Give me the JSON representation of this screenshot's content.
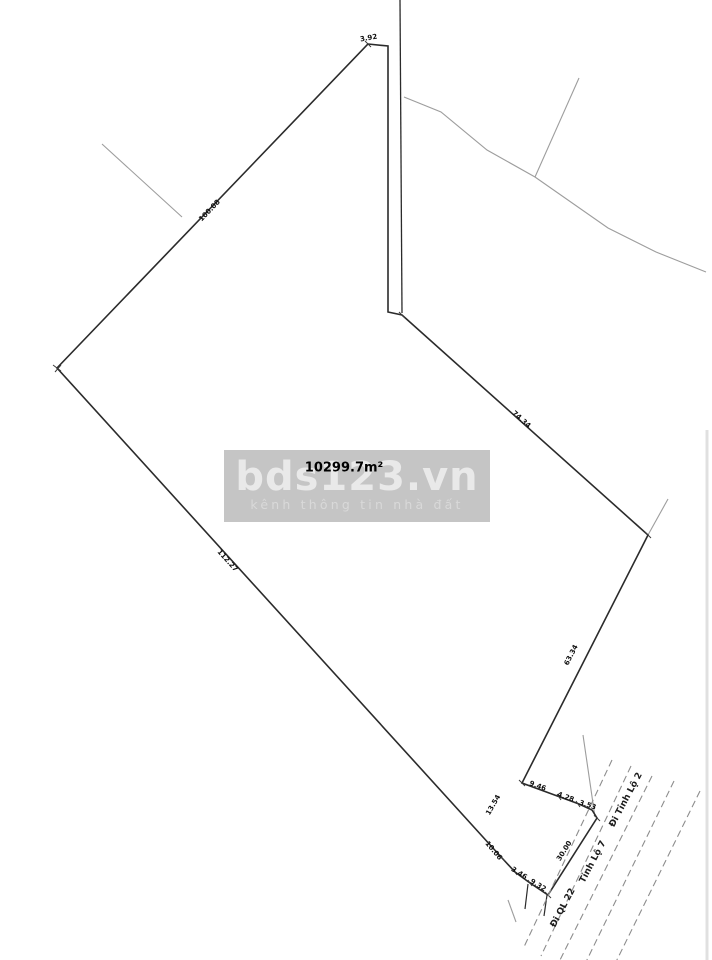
{
  "watermark": {
    "brand": "bds123.vn",
    "tagline": "kênh thông tin nhà đất"
  },
  "parcel": {
    "area_label": "10299.7m²",
    "measurements": [
      {
        "id": "top-edge",
        "text": "3.92",
        "x": 369,
        "y": 40,
        "rot": -10
      },
      {
        "id": "northwest-edge",
        "text": "100.08",
        "x": 211,
        "y": 212,
        "rot": -46
      },
      {
        "id": "southwest-edge",
        "text": "112.27",
        "x": 226,
        "y": 562,
        "rot": 48
      },
      {
        "id": "northeast-edge",
        "text": "74.34",
        "x": 520,
        "y": 421,
        "rot": 42
      },
      {
        "id": "east-edge",
        "text": "63.34",
        "x": 573,
        "y": 656,
        "rot": -63
      },
      {
        "id": "segment-9-46",
        "text": "9.46",
        "x": 537,
        "y": 788,
        "rot": 20
      },
      {
        "id": "segment-4-28",
        "text": "4.28",
        "x": 565,
        "y": 799,
        "rot": 20
      },
      {
        "id": "segment-3-53",
        "text": "3.53",
        "x": 587,
        "y": 807,
        "rot": 18
      },
      {
        "id": "segment-13-54",
        "text": "13.54",
        "x": 495,
        "y": 806,
        "rot": -60
      },
      {
        "id": "segment-10-06",
        "text": "10.06",
        "x": 492,
        "y": 852,
        "rot": 50
      },
      {
        "id": "segment-3-46",
        "text": "3.46",
        "x": 518,
        "y": 875,
        "rot": 32
      },
      {
        "id": "segment-9-32",
        "text": "9.32",
        "x": 537,
        "y": 887,
        "rot": 32
      },
      {
        "id": "road-frontage",
        "text": "30.00",
        "x": 566,
        "y": 852,
        "rot": -58
      }
    ]
  },
  "roads": {
    "labels": [
      {
        "id": "di-ql-22",
        "text": "Đi QL 22",
        "x": 565,
        "y": 909,
        "rot": -62
      },
      {
        "id": "tinh-lo-7",
        "text": "Tỉnh Lộ 7",
        "x": 595,
        "y": 863,
        "rot": -62
      },
      {
        "id": "di-tinh-lo-2",
        "text": "Đi Tỉnh Lộ 2",
        "x": 628,
        "y": 801,
        "rot": -62
      }
    ]
  },
  "colors": {
    "parcel_line": "#2b2b2b",
    "neighbor_line": "#9d9d9d",
    "road_line": "#8d8d8d",
    "tick": "#3a3a3a",
    "watermark_band": "#c5c5c5",
    "watermark_brand_text": "#e9e9e9",
    "watermark_tagline_text": "#d9d9d9",
    "photo_edge": "#e0e0e0"
  }
}
